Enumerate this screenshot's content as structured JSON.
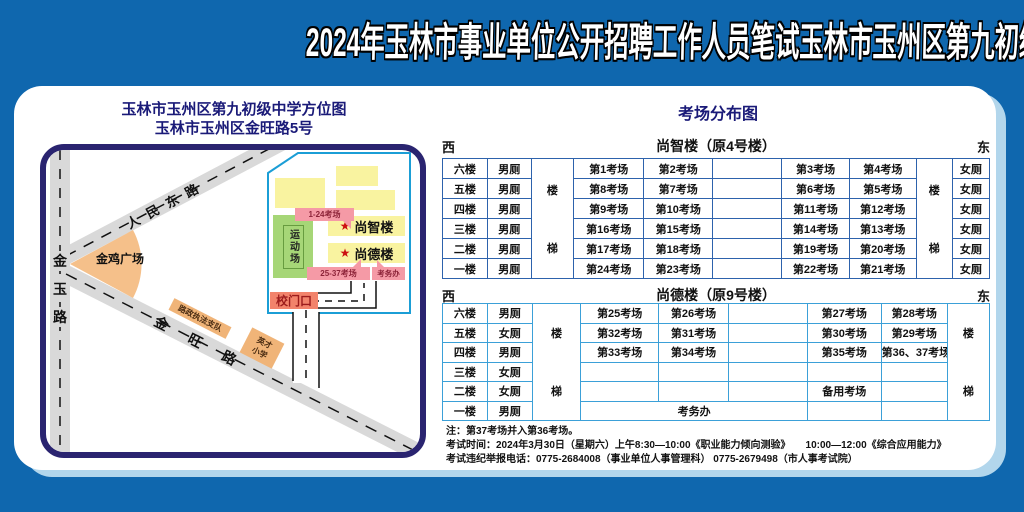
{
  "title": "2024年玉林市事业单位公开招聘工作人员笔试玉林市玉州区第九初级中学考点考场示意图",
  "map": {
    "title_line1": "玉林市玉州区第九初级中学方位图",
    "title_line2": "玉林市玉州区金旺路5号",
    "road_jinyu_chars": [
      "金",
      "玉",
      "路"
    ],
    "road_renmindong": "人民东路",
    "road_jinwang": "金旺路",
    "jinji_square": "金鸡广场",
    "luzheng_label": "路政执法支队",
    "yingcai_line1": "英才",
    "yingcai_line2": "小学",
    "gate_label": "校门口",
    "callout_shangzhi": "1-24考场",
    "callout_shangde": "25-37考场",
    "kaowu_label": "考务办",
    "sports_field": "运动场",
    "star": "★",
    "building_shangzhi": "尚智楼",
    "building_shangde": "尚德楼"
  },
  "distribution": {
    "title": "考场分布图",
    "west": "西",
    "east": "东",
    "stairs": [
      "楼",
      "梯"
    ],
    "t1": {
      "name": "尚智楼（原4号楼）",
      "rows": [
        [
          "六楼",
          "男厕",
          "第1考场",
          "第2考场",
          "",
          "第3考场",
          "第4考场",
          "女厕"
        ],
        [
          "五楼",
          "男厕",
          "第8考场",
          "第7考场",
          "",
          "第6考场",
          "第5考场",
          "女厕"
        ],
        [
          "四楼",
          "男厕",
          "第9考场",
          "第10考场",
          "",
          "第11考场",
          "第12考场",
          "女厕"
        ],
        [
          "三楼",
          "男厕",
          "第16考场",
          "第15考场",
          "",
          "第14考场",
          "第13考场",
          "女厕"
        ],
        [
          "二楼",
          "男厕",
          "第17考场",
          "第18考场",
          "",
          "第19考场",
          "第20考场",
          "女厕"
        ],
        [
          "一楼",
          "男厕",
          "第24考场",
          "第23考场",
          "",
          "第22考场",
          "第21考场",
          "女厕"
        ]
      ]
    },
    "t2": {
      "name": "尚德楼（原9号楼）",
      "rows": [
        [
          "六楼",
          "男厕",
          "第25考场",
          "第26考场",
          "",
          "第27考场",
          "第28考场"
        ],
        [
          "五楼",
          "女厕",
          "第32考场",
          "第31考场",
          "",
          "第30考场",
          "第29考场"
        ],
        [
          "四楼",
          "男厕",
          "第33考场",
          "第34考场",
          "",
          "第35考场",
          "第36、37考场"
        ],
        [
          "三楼",
          "女厕",
          "",
          "",
          "",
          "",
          ""
        ],
        [
          "二楼",
          "女厕",
          "",
          "",
          "",
          "备用考场",
          ""
        ],
        [
          "一楼",
          "男厕",
          "考务办",
          "",
          ""
        ]
      ]
    }
  },
  "notes": [
    "注：第37考场并入第36考场。",
    "考试时间：2024年3月30日（星期六）上午8:30—10:00《职业能力倾向测验》　　10:00—12:00《综合应用能力》",
    "考试违纪举报电话：0775-2684008（事业单位人事管理科） 0775-2679498（市人事考试院）"
  ],
  "colors": {
    "background_blue": "#0f67ae",
    "card_shadow": "#b2d6ec",
    "map_border_navy": "#2a2470",
    "heading_navy": "#1a1a78",
    "table1_border": "#2d62ac",
    "table2_border": "#3ba0d8",
    "building_yellow": "#f9f3a0",
    "field_green": "#a6d677",
    "callout_pink": "#f59aa6",
    "gate_red": "#f2836b",
    "plaza_orange": "#f5c08a",
    "label_orange": "#f0b478",
    "road_gray": "#d9d9d9",
    "boundary_blue": "#1b9ed6",
    "star_red": "#cc1111"
  }
}
